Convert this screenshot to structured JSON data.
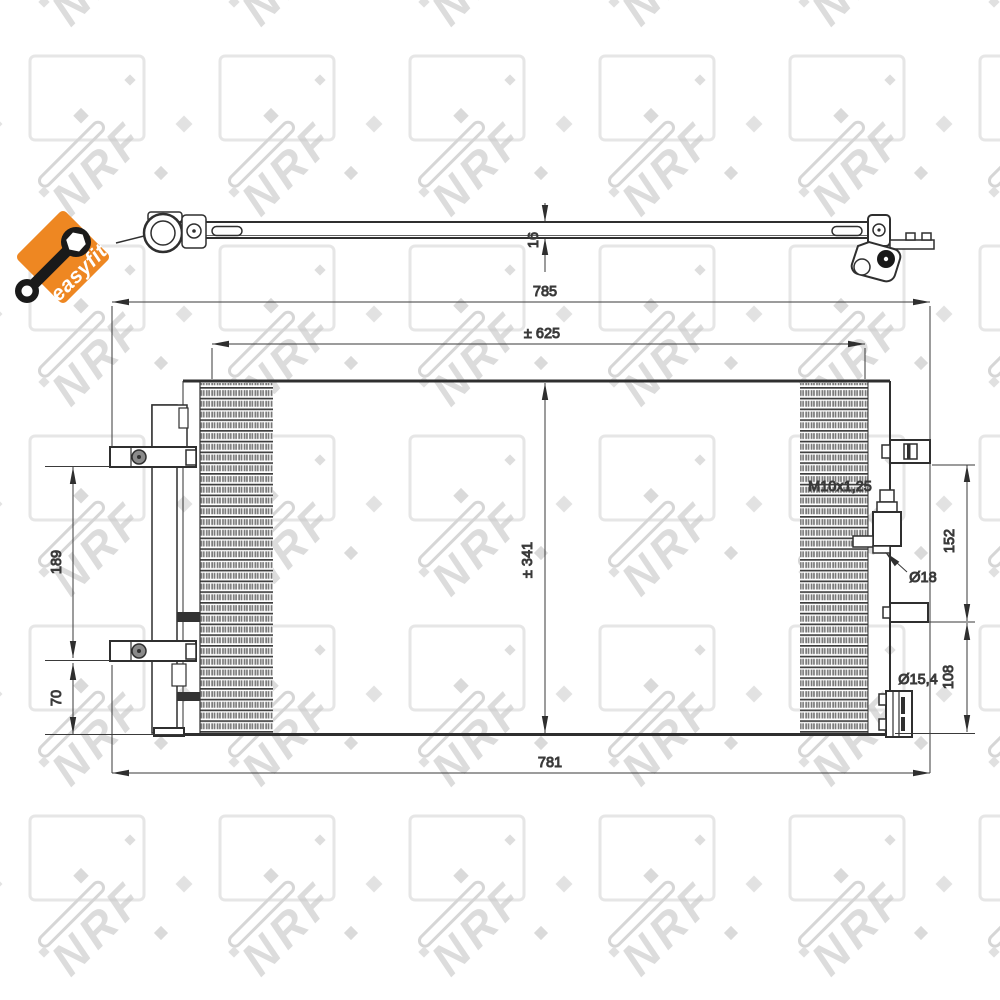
{
  "meta": {
    "background_color": "#ffffff",
    "line_color": "#2f2f2f",
    "text_color": "#3a3a3a"
  },
  "brand": {
    "name": "NRF",
    "watermark_text": "NRF",
    "badge_label": "easyfit",
    "badge_color": "#EE8722"
  },
  "drawing": {
    "type": "condenser technical drawing",
    "views": [
      "edge view (top)",
      "front view"
    ]
  },
  "dimensions": {
    "depth": "16",
    "overall_width": "785",
    "mount_width": "± 625",
    "core_height": "± 341",
    "bracket_span": "189",
    "bracket_bottom_offset": "70",
    "lower_width": "781",
    "upper_port_span": "152",
    "lower_port_span": "108",
    "thread_spec": "M10x1,25",
    "upper_port_diameter": "Ø18",
    "lower_port_diameter": "Ø15,4"
  }
}
